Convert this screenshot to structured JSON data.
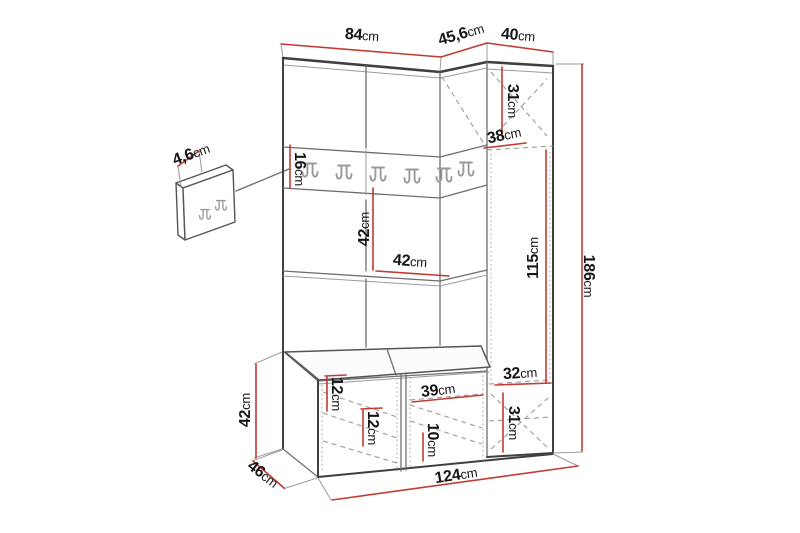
{
  "diagram": {
    "kind": "furniture-dimension-drawing",
    "accent_color": "#c23b31",
    "outline_color": "#3f3f3f"
  },
  "dims": {
    "main_top_width": {
      "value": "84",
      "unit": "cm"
    },
    "corner_top_width": {
      "value": "45,6",
      "unit": "cm"
    },
    "cabinet_top_width": {
      "value": "40",
      "unit": "cm"
    },
    "panel_thickness": {
      "value": "4,6",
      "unit": "cm"
    },
    "rail_height": {
      "value": "16",
      "unit": "cm"
    },
    "cabinet_upper_height": {
      "value": "31",
      "unit": "cm"
    },
    "cabinet_upper_depth": {
      "value": "38",
      "unit": "cm"
    },
    "mid_section_height": {
      "value": "42",
      "unit": "cm"
    },
    "mid_section_width": {
      "value": "42",
      "unit": "cm"
    },
    "door_height": {
      "value": "115",
      "unit": "cm"
    },
    "total_height": {
      "value": "186",
      "unit": "cm"
    },
    "cabinet_lower_width": {
      "value": "32",
      "unit": "cm"
    },
    "cabinet_lower_height": {
      "value": "31",
      "unit": "cm"
    },
    "bench_opening_width": {
      "value": "39",
      "unit": "cm"
    },
    "bench_opening_height": {
      "value": "10",
      "unit": "cm"
    },
    "bench_shelf_a": {
      "value": "12",
      "unit": "cm"
    },
    "bench_shelf_b": {
      "value": "12",
      "unit": "cm"
    },
    "bench_height": {
      "value": "42",
      "unit": "cm"
    },
    "bench_depth": {
      "value": "46",
      "unit": "cm"
    },
    "total_width": {
      "value": "124",
      "unit": "cm"
    }
  }
}
